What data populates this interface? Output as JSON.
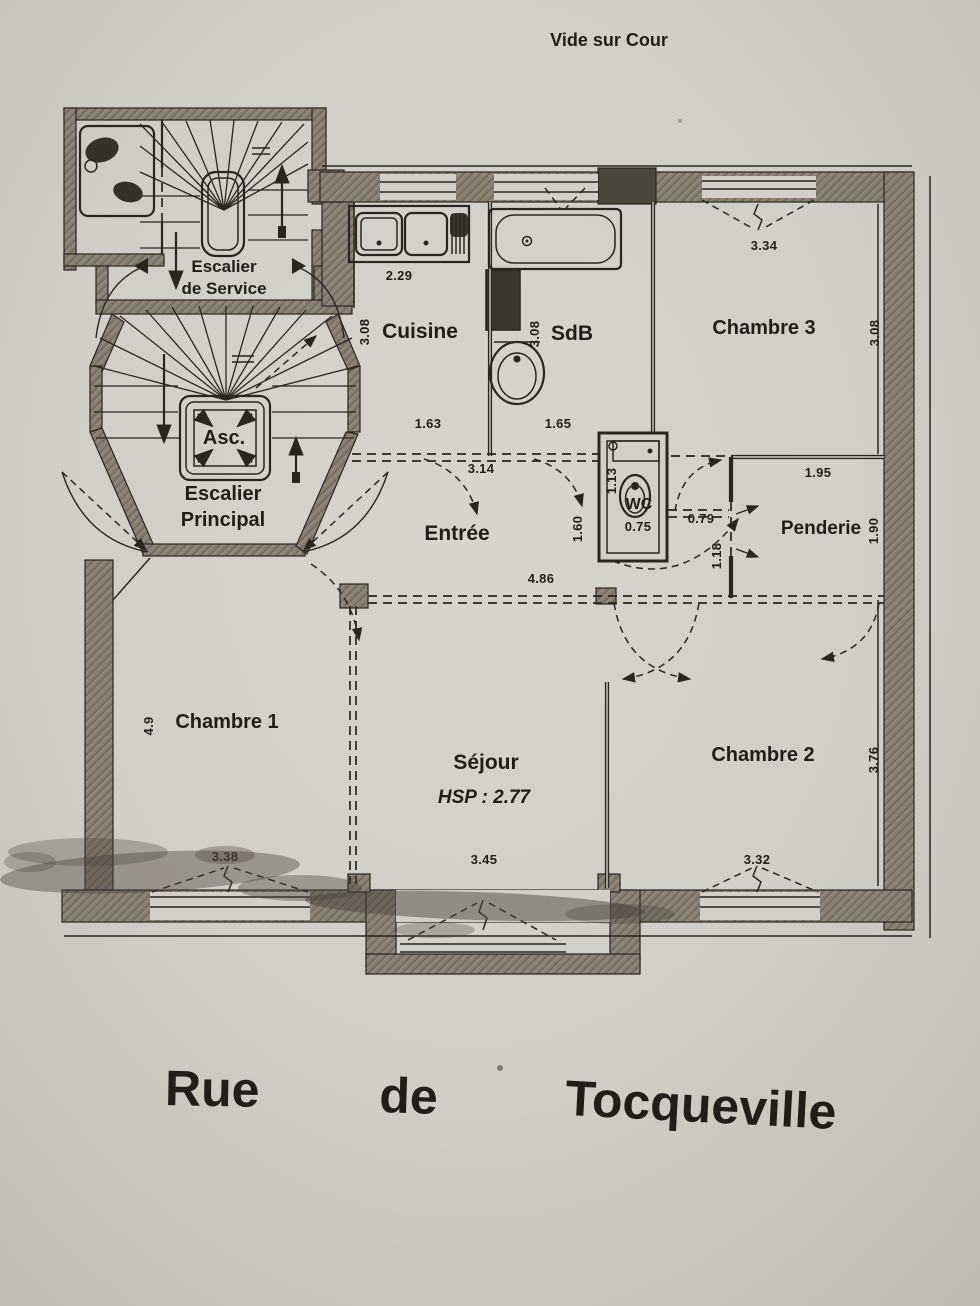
{
  "header": {
    "top_label": "Vide sur Cour"
  },
  "street": {
    "word1": "Rue",
    "word2": "de",
    "word3": "Tocqueville"
  },
  "rooms": {
    "service_stair_l1": "Escalier",
    "service_stair_l2": "de Service",
    "main_stair_l1": "Escalier",
    "main_stair_l2": "Principal",
    "elevator": "Asc.",
    "kitchen": "Cuisine",
    "bathroom": "SdB",
    "bedroom3": "Chambre 3",
    "entry": "Entrée",
    "wc": "WC",
    "closet": "Penderie",
    "bedroom1": "Chambre 1",
    "living": "Séjour",
    "living_ceiling_height": "HSP : 2.77",
    "bedroom2": "Chambre 2"
  },
  "dimensions": {
    "kitchen_counter": "2.29",
    "kitchen_depth": "3.08",
    "kitchen_width": "1.63",
    "bath_depth": "3.08",
    "bath_width": "1.65",
    "bedroom3_window": "3.34",
    "bedroom3_depth": "3.08",
    "entry_top": "3.14",
    "entry_width": "4.86",
    "wc_depth": "1.13",
    "wc_width": "0.75",
    "wc_side": "1.60",
    "hall_to_closet": "0.79",
    "closet_wall": "1.18",
    "closet_width": "1.95",
    "closet_depth": "1.90",
    "bedroom1_side": "4.9",
    "bedroom1_window": "3.38",
    "living_window": "3.45",
    "bedroom2_window": "3.32",
    "bedroom2_depth": "3.76"
  },
  "colors": {
    "paper": "#d3cfc8",
    "ink": "#2a261f",
    "wall_fill": "#847b6d",
    "smudge": "#4a4339"
  }
}
